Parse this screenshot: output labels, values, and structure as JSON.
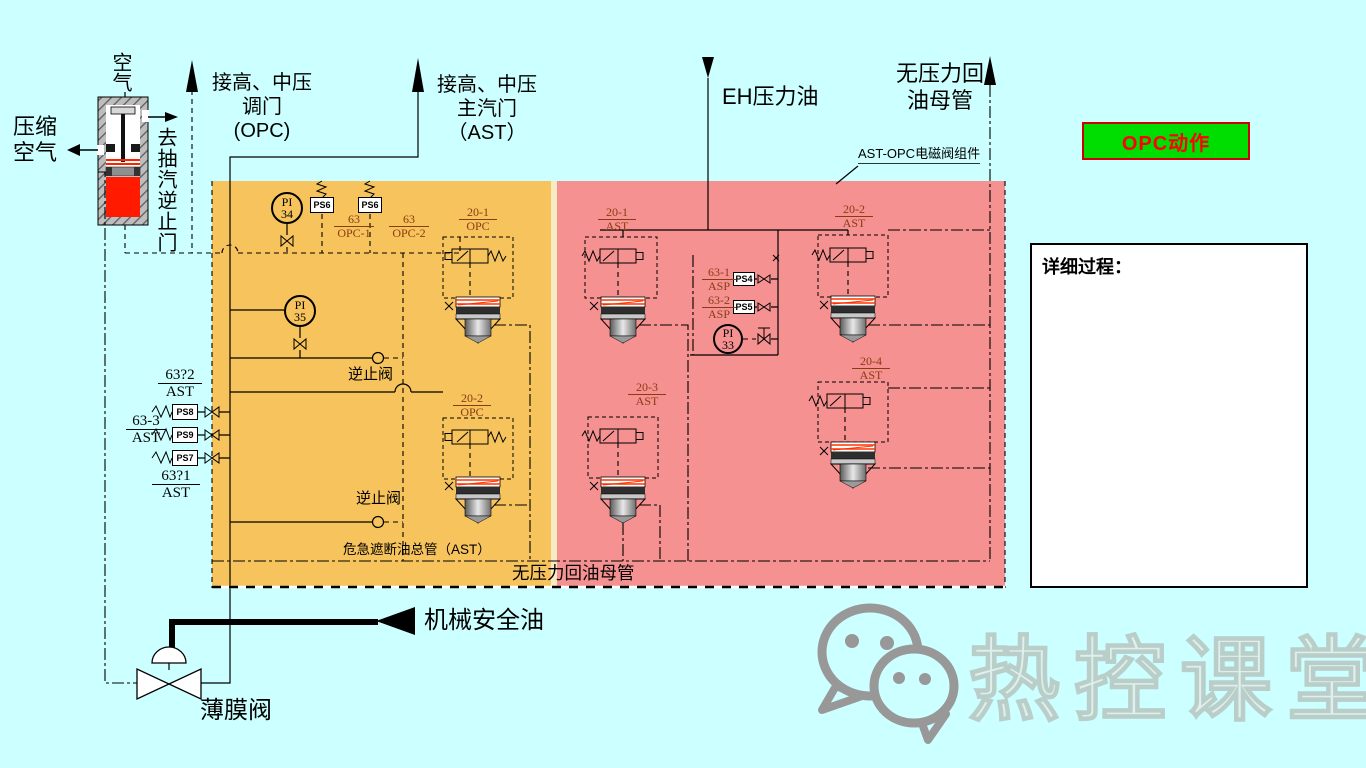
{
  "colors": {
    "background": "#CCFFFF",
    "opc_region": "#F6C35C",
    "ast_region": "#F69191",
    "button_bg": "#00DD00",
    "button_border": "#CC0000",
    "button_text": "#FF0000",
    "valve_red": "#FF1A00",
    "tag_color": "#8A3C10",
    "watermark_gray": "#989898"
  },
  "top_left": {
    "air": "空气",
    "compressed_air": [
      "压缩",
      "空气"
    ],
    "to_extraction_valve": "去抽汽逆止门"
  },
  "arrows": {
    "opc": [
      "接高、中压",
      "调门",
      "(OPC)"
    ],
    "ast": [
      "接高、中压",
      "主汽门",
      "（AST）"
    ],
    "eh_oil": "EH压力油",
    "return_main": [
      "无压力回",
      "油母管"
    ]
  },
  "assembly_label": "AST-OPC电磁阀组件",
  "button": {
    "label": "OPC动作"
  },
  "detail_panel": {
    "title": "详细过程："
  },
  "instruments": [
    {
      "line1": "PI",
      "line2": "34"
    },
    {
      "line1": "PI",
      "line2": "35"
    },
    {
      "line1": "PI",
      "line2": "33"
    }
  ],
  "switches": [
    "PS6",
    "PS6",
    "PS4",
    "PS5",
    "PS8",
    "PS9",
    "PS7"
  ],
  "tags": [
    {
      "top": "63",
      "bottom": "OPC-1"
    },
    {
      "top": "63",
      "bottom": "OPC-2"
    },
    {
      "top": "20-1",
      "bottom": "OPC"
    },
    {
      "top": "20-2",
      "bottom": "OPC"
    },
    {
      "top": "20-1",
      "bottom": "AST"
    },
    {
      "top": "20-3",
      "bottom": "AST"
    },
    {
      "top": "20-2",
      "bottom": "AST"
    },
    {
      "top": "20-4",
      "bottom": "AST"
    },
    {
      "top": "63-1",
      "bottom": "ASP"
    },
    {
      "top": "63-2",
      "bottom": "ASP"
    },
    {
      "top": "63?2",
      "bottom": "AST"
    },
    {
      "top": "63-3",
      "bottom": "AST"
    },
    {
      "top": "63?1",
      "bottom": "AST"
    }
  ],
  "pipe_labels": {
    "check_valve_top": "逆止阀",
    "check_valve_bottom": "逆止阀",
    "ast_header": "危急遮断油总管（AST）",
    "return_header": "无压力回油母管",
    "mech_safety_oil": "机械安全油",
    "membrane_valve": "薄膜阀"
  },
  "watermark": {
    "text": "热控课堂"
  }
}
